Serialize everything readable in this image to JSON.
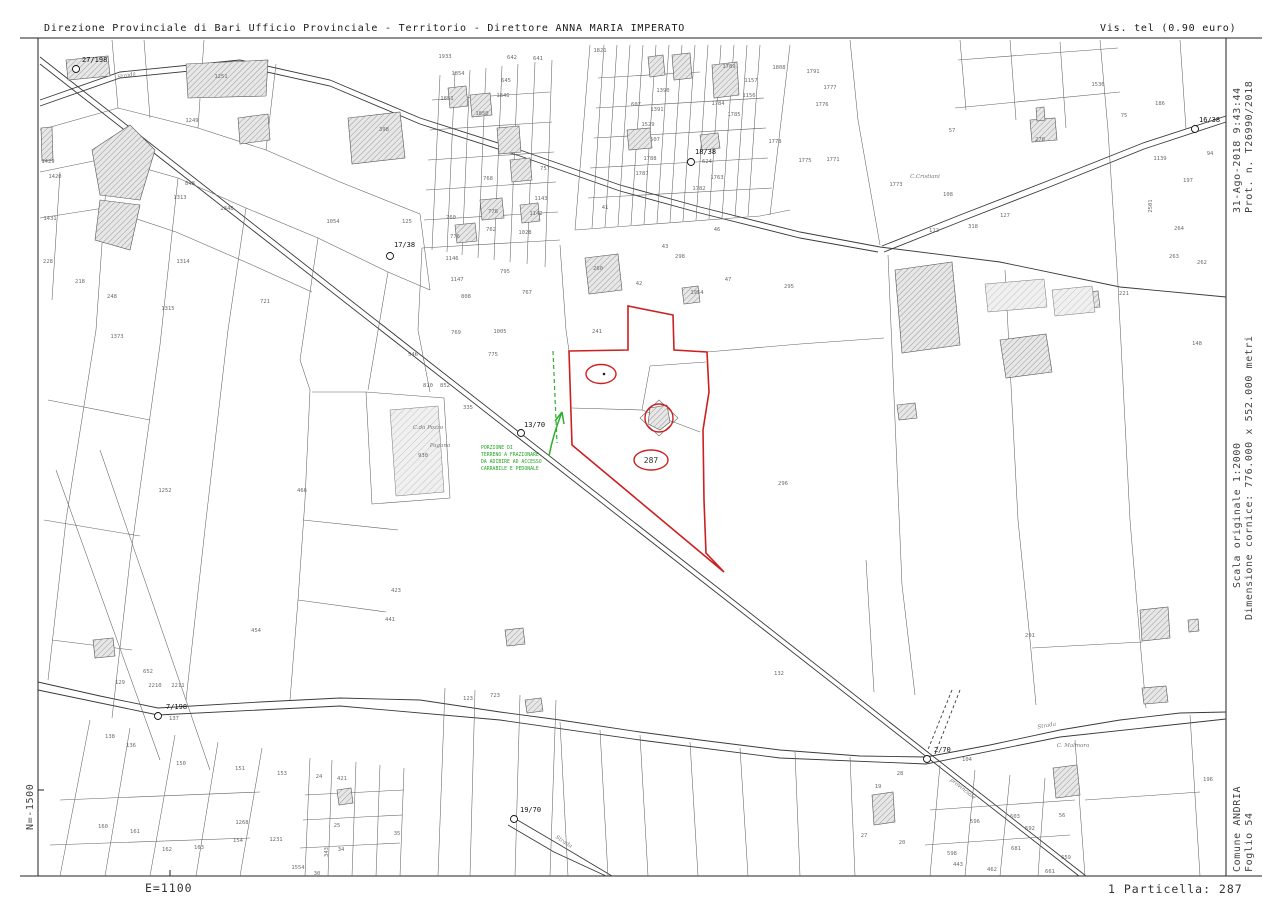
{
  "header": {
    "left": "Direzione Provinciale di Bari  Ufficio Provinciale - Territorio - Direttore ANNA MARIA IMPERATO",
    "right": "Vis. tel (0.90 euro)"
  },
  "margins": {
    "right_top_1": "31-Ago-2018 9:43:44",
    "right_top_2": "Prot. n. T26990/2018",
    "right_mid_1": "Scala originale 1:2000",
    "right_mid_2": "Dimensione cornice: 776.000 x 552.000 metri",
    "right_bot_1": "Comune  ANDRIA",
    "right_bot_2": "Foglio  54",
    "left_coord": "N=-1500",
    "footer_left": "E=1100",
    "footer_right": "1 Particella: 287"
  },
  "map": {
    "subject_parcel": "287",
    "colors": {
      "red": "#cc2020",
      "green": "#2bb02b",
      "line": "#616161"
    },
    "annotation": {
      "lines": [
        "PORZIONE DI",
        "TERRENO A FRAZIONARE",
        "DA ADIBIRE AD ACCESSO",
        "CARRABILE E PEDONALE"
      ],
      "x": 481,
      "y": 449
    },
    "benchmarks": [
      {
        "t": "27/198",
        "tx": 82,
        "ty": 62,
        "cx": 76,
        "cy": 69
      },
      {
        "t": "17/38",
        "tx": 394,
        "ty": 247,
        "cx": 390,
        "cy": 256
      },
      {
        "t": "18/38",
        "tx": 695,
        "ty": 154,
        "cx": 691,
        "cy": 162
      },
      {
        "t": "16/38",
        "tx": 1199,
        "ty": 122,
        "cx": 1195,
        "cy": 129
      },
      {
        "t": "13/70",
        "tx": 524,
        "ty": 427,
        "cx": 521,
        "cy": 433
      },
      {
        "t": "7/198",
        "tx": 166,
        "ty": 709,
        "cx": 158,
        "cy": 716
      },
      {
        "t": "19/70",
        "tx": 520,
        "ty": 812,
        "cx": 514,
        "cy": 819
      },
      {
        "t": "2/70",
        "tx": 934,
        "ty": 752,
        "cx": 927,
        "cy": 759
      }
    ],
    "road_labels": [
      {
        "t": "Strada",
        "x": 127,
        "y": 77,
        "r": -12
      },
      {
        "t": "Strada",
        "x": 1047,
        "y": 727,
        "r": -10
      },
      {
        "t": "Strada",
        "x": 563,
        "y": 843,
        "r": 33
      },
      {
        "t": "provinciale",
        "x": 962,
        "y": 790,
        "r": 38
      }
    ],
    "names": [
      {
        "t": "C.Cristiani",
        "x": 925,
        "y": 178
      },
      {
        "t": "C. Malmora",
        "x": 1073,
        "y": 747
      },
      {
        "t": "C.da Pozzo",
        "x": 428,
        "y": 429
      },
      {
        "t": "Pagano",
        "x": 440,
        "y": 447
      }
    ],
    "parcels": [
      [
        "1249",
        192,
        122
      ],
      [
        "1251",
        221,
        78
      ],
      [
        "398",
        384,
        131
      ],
      [
        "848",
        190,
        185
      ],
      [
        "1313",
        180,
        199
      ],
      [
        "2348",
        227,
        210
      ],
      [
        "1314",
        183,
        263
      ],
      [
        "1315",
        168,
        310
      ],
      [
        "721",
        265,
        303
      ],
      [
        "1373",
        117,
        338
      ],
      [
        "1054",
        333,
        223
      ],
      [
        "125",
        407,
        223
      ],
      [
        "1429",
        48,
        163
      ],
      [
        "1420",
        55,
        178
      ],
      [
        "1431",
        50,
        220
      ],
      [
        "218",
        80,
        283
      ],
      [
        "248",
        112,
        298
      ],
      [
        "228",
        48,
        263
      ],
      [
        "1821",
        600,
        52
      ],
      [
        "1933",
        445,
        58
      ],
      [
        "1854",
        458,
        75
      ],
      [
        "1851",
        447,
        100
      ],
      [
        "1850",
        482,
        115
      ],
      [
        "1846",
        503,
        97
      ],
      [
        "645",
        506,
        82
      ],
      [
        "642",
        512,
        59
      ],
      [
        "641",
        538,
        60
      ],
      [
        "1390",
        663,
        92
      ],
      [
        "607",
        636,
        106
      ],
      [
        "1391",
        657,
        111
      ],
      [
        "1529",
        648,
        126
      ],
      [
        "507",
        655,
        141
      ],
      [
        "1788",
        650,
        160
      ],
      [
        "1787",
        642,
        175
      ],
      [
        "1782",
        699,
        190
      ],
      [
        "1763",
        717,
        179
      ],
      [
        "624",
        707,
        163
      ],
      [
        "1157",
        751,
        82
      ],
      [
        "1156",
        749,
        97
      ],
      [
        "1784",
        718,
        105
      ],
      [
        "1785",
        734,
        116
      ],
      [
        "1789",
        729,
        68
      ],
      [
        "1778",
        775,
        143
      ],
      [
        "1775",
        805,
        162
      ],
      [
        "1771",
        833,
        161
      ],
      [
        "1776",
        822,
        106
      ],
      [
        "1777",
        830,
        89
      ],
      [
        "1808",
        779,
        69
      ],
      [
        "1791",
        813,
        73
      ],
      [
        "1536",
        1098,
        86
      ],
      [
        "757",
        545,
        170
      ],
      [
        "1143",
        541,
        200
      ],
      [
        "1142",
        536,
        215
      ],
      [
        "1028",
        525,
        234
      ],
      [
        "778",
        493,
        213
      ],
      [
        "768",
        488,
        180
      ],
      [
        "762",
        491,
        231
      ],
      [
        "776",
        455,
        238
      ],
      [
        "760",
        451,
        219
      ],
      [
        "1146",
        452,
        260
      ],
      [
        "1147",
        457,
        281
      ],
      [
        "795",
        505,
        273
      ],
      [
        "767",
        527,
        294
      ],
      [
        "808",
        466,
        298
      ],
      [
        "41",
        605,
        209
      ],
      [
        "43",
        665,
        248
      ],
      [
        "42",
        639,
        285
      ],
      [
        "46",
        717,
        231
      ],
      [
        "47",
        728,
        281
      ],
      [
        "295",
        789,
        288
      ],
      [
        "298",
        680,
        258
      ],
      [
        "1954",
        697,
        294
      ],
      [
        "260",
        598,
        270
      ],
      [
        "241",
        597,
        333
      ],
      [
        "57",
        952,
        132
      ],
      [
        "278",
        1040,
        141
      ],
      [
        "318",
        973,
        228
      ],
      [
        "1773",
        896,
        186
      ],
      [
        "108",
        948,
        196
      ],
      [
        "112",
        934,
        232
      ],
      [
        "127",
        1005,
        217
      ],
      [
        "94",
        1210,
        155
      ],
      [
        "197",
        1188,
        182
      ],
      [
        "1139",
        1160,
        160
      ],
      [
        "2501",
        1152,
        206,
        -90
      ],
      [
        "264",
        1179,
        230
      ],
      [
        "263",
        1174,
        258
      ],
      [
        "262",
        1202,
        264
      ],
      [
        "221",
        1124,
        295
      ],
      [
        "186",
        1160,
        105
      ],
      [
        "75",
        1124,
        117
      ],
      [
        "148",
        1197,
        345
      ],
      [
        "291",
        1030,
        637
      ],
      [
        "296",
        783,
        485
      ],
      [
        "132",
        779,
        675
      ],
      [
        "1005",
        500,
        333
      ],
      [
        "769",
        456,
        334
      ],
      [
        "775",
        493,
        356
      ],
      [
        "546",
        413,
        356
      ],
      [
        "852",
        445,
        387
      ],
      [
        "810",
        428,
        387
      ],
      [
        "335",
        468,
        409
      ],
      [
        "930",
        423,
        457
      ],
      [
        "1252",
        165,
        492
      ],
      [
        "466",
        302,
        492
      ],
      [
        "454",
        256,
        632
      ],
      [
        "441",
        390,
        621
      ],
      [
        "423",
        396,
        592
      ],
      [
        "723",
        495,
        697
      ],
      [
        "123",
        468,
        700
      ],
      [
        "129",
        120,
        684
      ],
      [
        "652",
        148,
        673
      ],
      [
        "2210",
        155,
        687
      ],
      [
        "2211",
        178,
        687
      ],
      [
        "137",
        174,
        720
      ],
      [
        "138",
        110,
        738
      ],
      [
        "136",
        131,
        747
      ],
      [
        "150",
        181,
        765
      ],
      [
        "151",
        240,
        770
      ],
      [
        "153",
        282,
        775
      ],
      [
        "160",
        103,
        828
      ],
      [
        "161",
        135,
        833
      ],
      [
        "162",
        167,
        851
      ],
      [
        "163",
        199,
        849
      ],
      [
        "154",
        238,
        842
      ],
      [
        "1268",
        242,
        824
      ],
      [
        "1231",
        276,
        841
      ],
      [
        "1554",
        298,
        869
      ],
      [
        "24",
        319,
        778
      ],
      [
        "421",
        342,
        780
      ],
      [
        "25",
        337,
        827
      ],
      [
        "35",
        397,
        835
      ],
      [
        "34",
        341,
        851
      ],
      [
        "343",
        328,
        852,
        -90
      ],
      [
        "30",
        317,
        875
      ],
      [
        "104",
        967,
        761
      ],
      [
        "19",
        878,
        788
      ],
      [
        "28",
        900,
        775
      ],
      [
        "27",
        864,
        837
      ],
      [
        "20",
        902,
        844
      ],
      [
        "603",
        1015,
        818
      ],
      [
        "596",
        975,
        823
      ],
      [
        "592",
        1030,
        830
      ],
      [
        "598",
        952,
        855
      ],
      [
        "681",
        1016,
        850
      ],
      [
        "443",
        958,
        866
      ],
      [
        "462",
        992,
        871
      ],
      [
        "659",
        1066,
        859
      ],
      [
        "661",
        1050,
        873
      ],
      [
        "56",
        1062,
        817
      ],
      [
        "196",
        1208,
        781
      ]
    ]
  }
}
